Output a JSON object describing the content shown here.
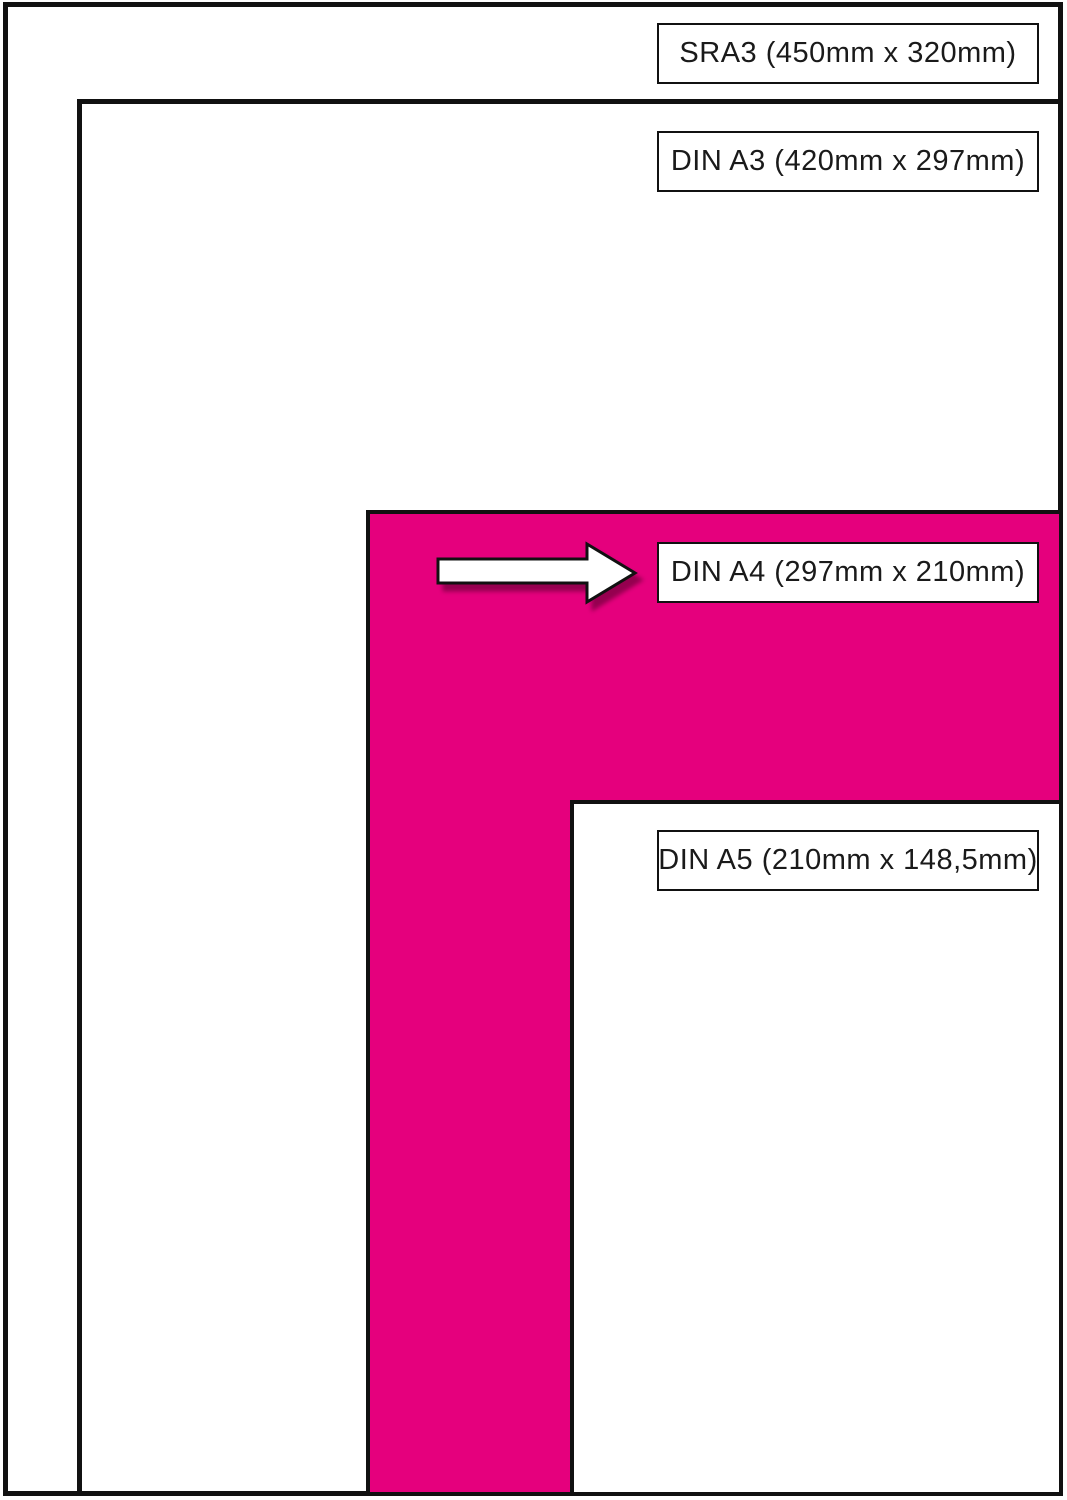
{
  "labels": {
    "sra3": "SRA3 (450mm x 320mm)",
    "a3": "DIN A3 (420mm x 297mm)",
    "a4": "DIN A4 (297mm x 210mm)",
    "a5": "DIN A5 (210mm x 148,5mm)"
  },
  "colors": {
    "highlight_pink": "#E5007D",
    "border_ink": "#111111",
    "background": "#FFFFFF"
  },
  "icons": {
    "arrow": "arrow-right-icon"
  }
}
